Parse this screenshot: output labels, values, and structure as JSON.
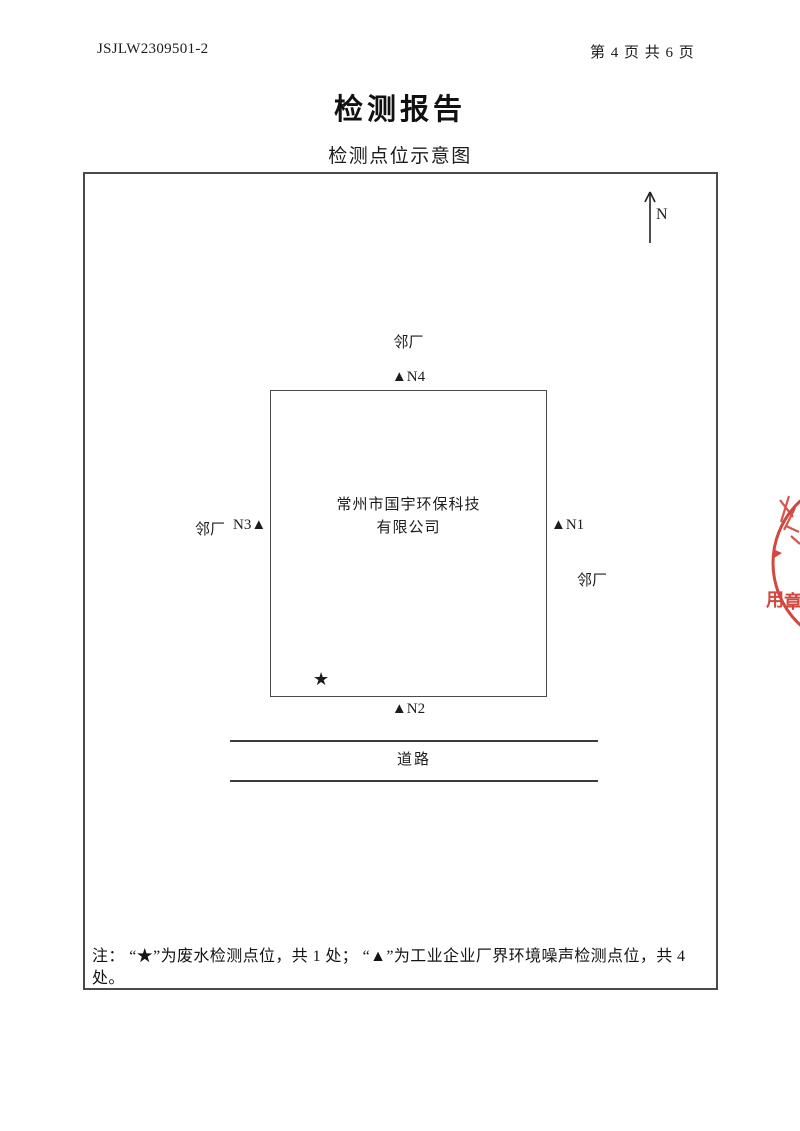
{
  "header": {
    "doc_number": "JSJLW2309501-2",
    "page_info": "第 4 页 共 6 页"
  },
  "title": "检测报告",
  "subtitle": "检测点位示意图",
  "diagram": {
    "north_label": "N",
    "neighbor_top": "邻厂",
    "neighbor_left": "邻厂",
    "neighbor_right": "邻厂",
    "point_n4": "▲N4",
    "point_n3": "N3▲",
    "point_n1": "▲N1",
    "point_n2": "▲N2",
    "wastewater_marker": "★",
    "company_line1": "常州市国宇环保科技",
    "company_line2": "有限公司",
    "road_label": "道路"
  },
  "note": {
    "lines": [
      "注： “★”为废水检测点位，共 1 处； “▲”为工业企业厂界环境噪声检测点位，共 4",
      "处。"
    ]
  },
  "stamp": {
    "color": "#d2473e",
    "char1": "用",
    "char2": "章"
  }
}
